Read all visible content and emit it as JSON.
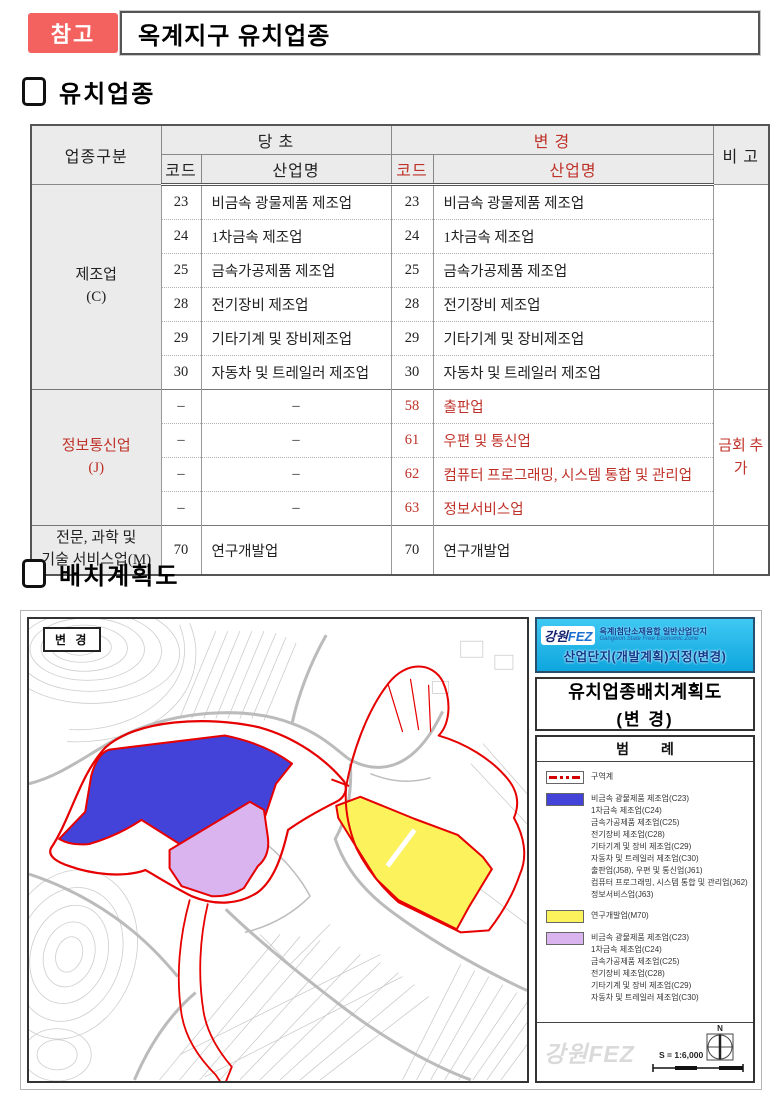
{
  "page": {
    "badge": "참고",
    "title": "옥계지구 유치업종"
  },
  "section1": {
    "title": "유치업종"
  },
  "section2": {
    "title": "배치계획도"
  },
  "table": {
    "header": {
      "category": "업종구분",
      "original": "당 초",
      "changed": "변 경",
      "code_orig": "코드",
      "name_orig": "산업명",
      "code_new": "코드",
      "name_new": "산업명",
      "remarks": "비 고"
    },
    "groups": [
      {
        "category_l1": "제조업",
        "category_l2": "(C)",
        "remark": "",
        "rows": [
          {
            "oc": "23",
            "on": "비금속 광물제품 제조업",
            "nc": "23",
            "nn": "비금속 광물제품 제조업"
          },
          {
            "oc": "24",
            "on": "1차금속 제조업",
            "nc": "24",
            "nn": "1차금속 제조업"
          },
          {
            "oc": "25",
            "on": "금속가공제품 제조업",
            "nc": "25",
            "nn": "금속가공제품 제조업"
          },
          {
            "oc": "28",
            "on": "전기장비 제조업",
            "nc": "28",
            "nn": "전기장비 제조업"
          },
          {
            "oc": "29",
            "on": "기타기계 및 장비제조업",
            "nc": "29",
            "nn": "기타기계 및 장비제조업"
          },
          {
            "oc": "30",
            "on": "자동차 및 트레일러 제조업",
            "nc": "30",
            "nn": "자동차 및 트레일러 제조업"
          }
        ]
      },
      {
        "category_l1": "정보통신업",
        "category_l2": "(J)",
        "remark": "금회 추가",
        "rows": [
          {
            "oc": "–",
            "on": "–",
            "nc": "58",
            "nn": "출판업"
          },
          {
            "oc": "–",
            "on": "–",
            "nc": "61",
            "nn": "우편 및 통신업"
          },
          {
            "oc": "–",
            "on": "–",
            "nc": "62",
            "nn": "컴퓨터 프로그래밍, 시스템 통합 및 관리업"
          },
          {
            "oc": "–",
            "on": "–",
            "nc": "63",
            "nn": "정보서비스업"
          }
        ]
      },
      {
        "category_l1": "전문, 과학 및",
        "category_l2": "기술 서비스업(M)",
        "remark": "",
        "rows": [
          {
            "oc": "70",
            "on": "연구개발업",
            "nc": "70",
            "nn": "연구개발업"
          }
        ]
      }
    ]
  },
  "map": {
    "change_label": "변 경",
    "panel": {
      "logo_left": "강원",
      "logo_right": "FEZ",
      "header_title": "옥계|첨단소재융합 일반산업단지",
      "header_sub": "Gangwon State Free Economic Zone",
      "header_line2": "산업단지(개발계획)지정(변경)",
      "doc_title_l1": "유치업종배치계획도",
      "doc_title_l2": "(변 경)",
      "legend_title": "범  례",
      "legend_boundary_label": "구역계",
      "legend_blue_lines": [
        "비금속 광물제품 제조업(C23)",
        "1차금속 제조업(C24)",
        "금속가공제품 제조업(C25)",
        "전기장비 제조업(C28)",
        "기타기계 및 장비 제조업(C29)",
        "자동차 및 트레일러 제조업(C30)",
        "출판업(J58), 우편 및 통신업(J61)",
        "컴퓨터 프로그래밍, 시스템 통합 및 관리업(J62)",
        "정보서비스업(J63)"
      ],
      "legend_yellow_lines": [
        "연구개발업(M70)"
      ],
      "legend_purple_lines": [
        "비금속 광물제품 제조업(C23)",
        "1차금속 제조업(C24)",
        "금속가공제품 제조업(C25)",
        "전기장비 제조업(C28)",
        "기타기계 및 장비 제조업(C29)",
        "자동차 및 트레일러 제조업(C30)"
      ],
      "watermark": "강원FEZ",
      "north_label": "N",
      "scale_label": "S = 1:6,000"
    },
    "colors": {
      "boundary_red": "#e60000",
      "zone_blue": "#4343da",
      "zone_yellow": "#fcf25c",
      "zone_purple": "#d9b4ee",
      "panel_blue": "#25bdf0",
      "accent_red": "#bf3229",
      "badge_red": "#f4625f"
    }
  }
}
